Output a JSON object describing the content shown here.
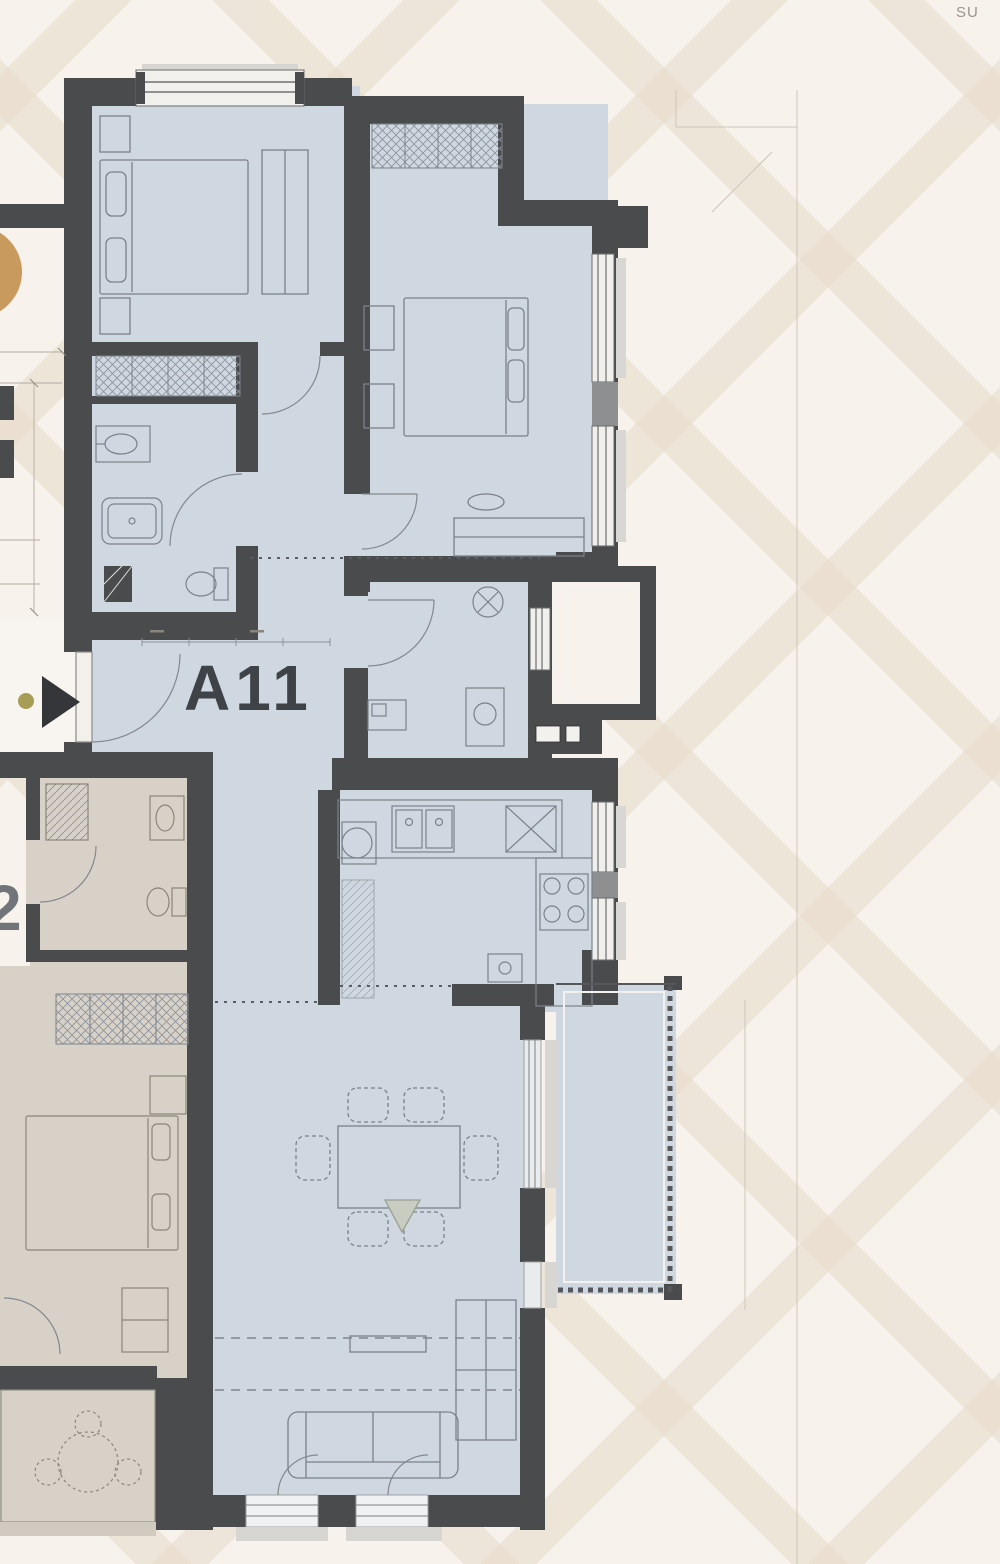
{
  "canvas": {
    "width": 1000,
    "height": 1564
  },
  "site": {
    "corner_text": "SU",
    "background_color": "#f7f2ec",
    "pattern_band_color": "#e6dacA"
  },
  "floor_plan": {
    "unit_label": "A11",
    "adjacent_unit_label": "2",
    "unit_room_fill": "#cfd7e0",
    "adjacent_room_fill": "#d8d1c7",
    "wall_color": "#4a4b4d",
    "balcony_fill": "#cfd7e0",
    "window_frame_color": "#6a6b6d",
    "sill_color": "#d7d5d1",
    "furniture_line_color": "#7b818a"
  },
  "markers": {
    "entrance_arrow_icon": "right-pointing-triangle",
    "entrance_arrow_color": "#35363a",
    "entrance_dot_color": "#a89d55",
    "site_circle_color": "#c89a5e"
  }
}
